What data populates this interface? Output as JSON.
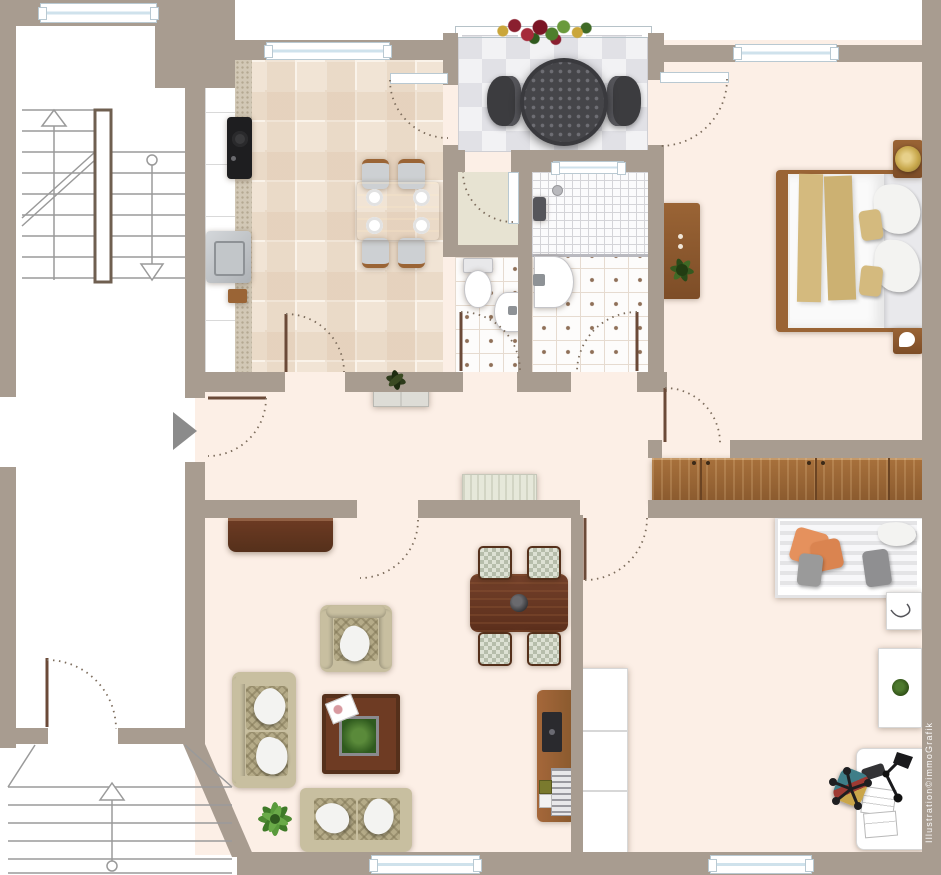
{
  "watermark": "Illustration©immoGrafik",
  "colors": {
    "outside": "#ffffff",
    "wall": "#a89c90",
    "floor": "#fcefe6",
    "kitchenTile": "#f1e4d5",
    "tileLine": "#faf3ea",
    "balconyA": "#f2f2f4",
    "balconyB": "#e1e1e6",
    "vestibule": "#e7e3d2",
    "bathFloor": "#fdfcfb",
    "bathDot": "#8f7058",
    "bathTileLine": "#e6dbd0",
    "showerLine": "#d4d4d8",
    "woodLight": "#b9894c",
    "woodMid": "#9a6435",
    "woodDark": "#6e3b23",
    "woodDeep": "#55301b",
    "sofa": "#c8bfa0",
    "sofaTrim": "#b5ab88",
    "pillow": "#f3f3f1",
    "tan": "#d4ba7e",
    "gray": "#9a9a9a",
    "orange": "#e5915d",
    "plant": "#4c8434",
    "plantDark": "#2f5a1e",
    "dark": "#3c3c3f",
    "steel": "#c6c9cc",
    "white": "#ffffff",
    "arrow": "#8b8b8b",
    "arc": "#7c6c5c",
    "windowGlass": "#cfe2ec",
    "windowFrame": "#b9c9d2",
    "counter": "#d2c8b6",
    "daybedA": "#e4e4e6",
    "daybedB": "#f7f7f9",
    "checkA": "#b6bdab",
    "gold": "#c9a94e",
    "teal": "#3f7e88",
    "red": "#9e3a33",
    "watermark": "#ffffff"
  },
  "plan": {
    "rooms": [
      {
        "name": "staircase-top",
        "furniture": [
          "staircase-with-up-down-arrows"
        ]
      },
      {
        "name": "kitchen",
        "furniture": [
          "kitchen-counter",
          "cooktop",
          "kitchen-sink",
          "dining-table",
          "four-chairs",
          "four-plates"
        ]
      },
      {
        "name": "balcony",
        "furniture": [
          "round-perforated-table",
          "two-balcony-chairs",
          "flower-box",
          "railing"
        ]
      },
      {
        "name": "storage-vestibule",
        "furniture": [
          "balcony-door"
        ]
      },
      {
        "name": "wc",
        "furniture": [
          "toilet",
          "small-washbasin"
        ]
      },
      {
        "name": "bathroom",
        "furniture": [
          "shower",
          "washbasin",
          "window"
        ]
      },
      {
        "name": "bedroom",
        "furniture": [
          "double-bed",
          "nightstand-with-gold-lamp",
          "nightstand",
          "dresser-with-plant"
        ]
      },
      {
        "name": "hallway",
        "furniture": [
          "entrance-arrow",
          "cabinet-with-plant",
          "bench",
          "long-wardrobe"
        ]
      },
      {
        "name": "living-room",
        "furniture": [
          "sideboard",
          "armchair",
          "sofa-left",
          "sofa-bottom",
          "coffee-table-with-plant",
          "floor-plant",
          "dining-table-with-four-chairs",
          "tv-board"
        ]
      },
      {
        "name": "office-room",
        "furniture": [
          "white-wardrobe",
          "daybed-with-pillows",
          "nightstand-with-sketch",
          "side-table-with-plant",
          "desk",
          "desk-lamp",
          "office-chair",
          "papers",
          "phone"
        ]
      },
      {
        "name": "staircase-bottom",
        "furniture": [
          "staircase-with-up-arrow"
        ]
      }
    ]
  }
}
